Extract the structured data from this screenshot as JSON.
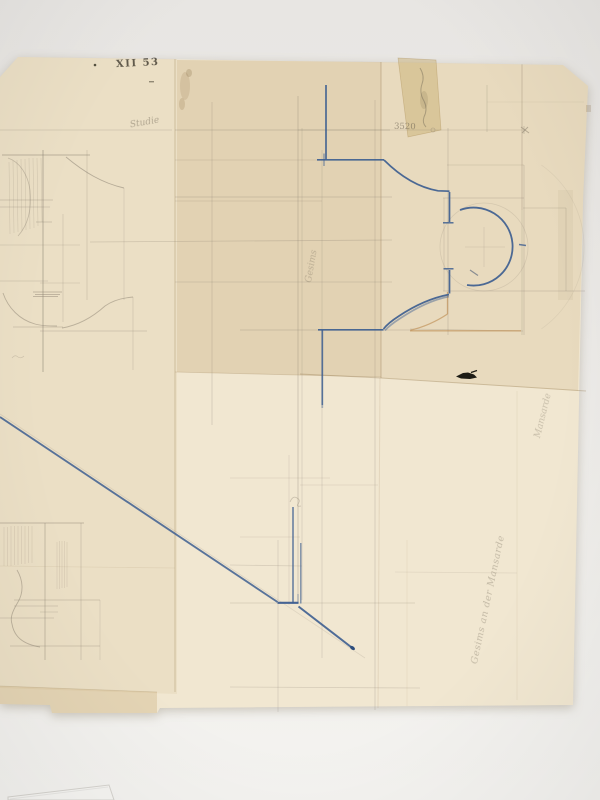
{
  "scan": {
    "background_top": "#e8e6e3",
    "background_bottom": "#f4f3f0"
  },
  "sheet": {
    "base_color": "#f1e7d1",
    "left_panel_tint": "rgba(208,182,136,0.16)",
    "top_strip_tint": "rgba(193,163,108,0.30)",
    "top_right_tint": "rgba(198,170,116,0.20)",
    "bottom_strip_tint": "rgba(198,168,112,0.30)",
    "ink_blue": "#3d5e90",
    "pencil_gray": "#8b8172",
    "orange_guide": "#bf8f54",
    "crease_brown": "rgba(150,122,80,0.35)",
    "tape_color": "rgba(200,172,110,0.45)"
  },
  "annotations": {
    "catalog_number": "XII 53",
    "sketch_label": "Studie",
    "dimension_value": "3520",
    "center_margin_note": "Gesims",
    "right_margin_note": "Mansarde",
    "bottom_margin_note": "Gesims an der Mansarde"
  }
}
